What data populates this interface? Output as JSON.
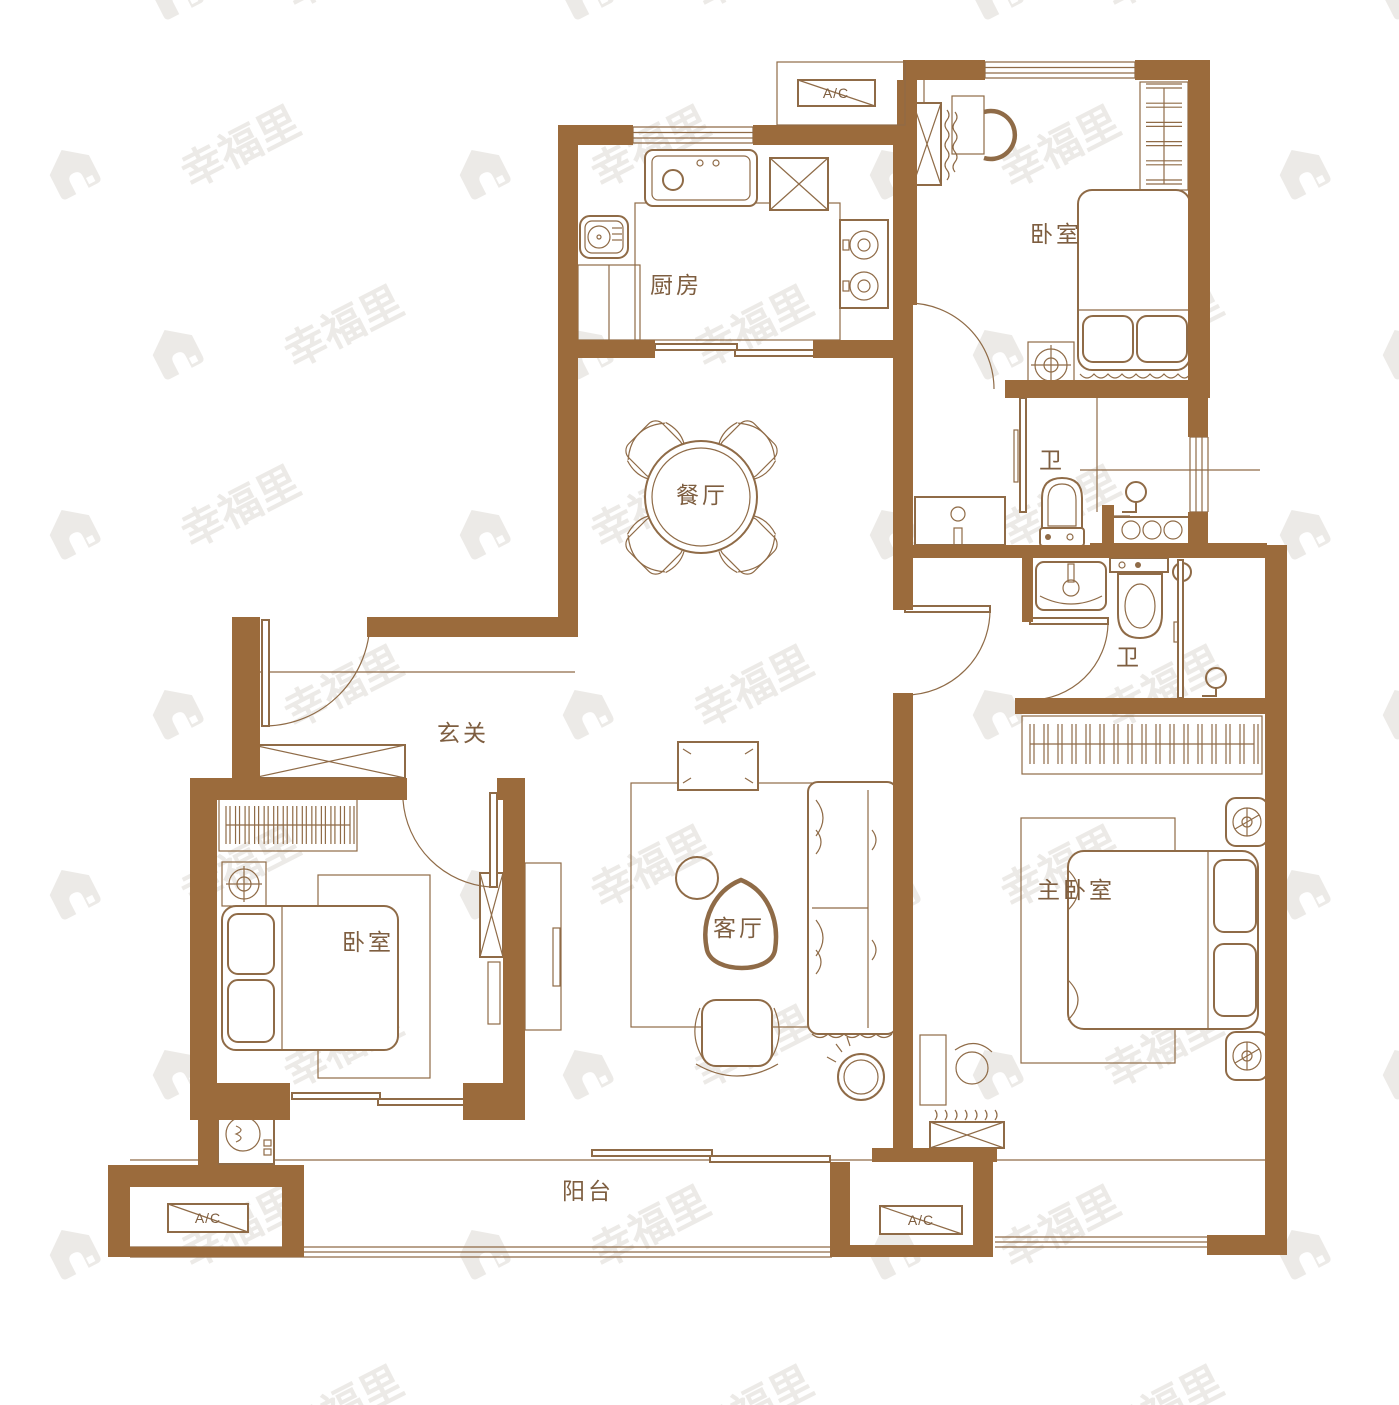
{
  "meta": {
    "title": "apartment-floor-plan",
    "width": 1399,
    "height": 1405
  },
  "palette": {
    "wall": "#9B6B3C",
    "line": "#8F6B47",
    "label": "#7E5E40",
    "watermark": "#ECEAE7",
    "background": "#FFFFFF"
  },
  "rooms": [
    {
      "id": "kitchen",
      "label": "厨房",
      "x": 676,
      "y": 293
    },
    {
      "id": "bedroom-top-right",
      "label": "卧室",
      "x": 1056,
      "y": 242
    },
    {
      "id": "dining-room",
      "label": "餐厅",
      "x": 702,
      "y": 503
    },
    {
      "id": "bathroom-1",
      "label": "卫",
      "x": 1052,
      "y": 468
    },
    {
      "id": "bathroom-2",
      "label": "卫",
      "x": 1129,
      "y": 665
    },
    {
      "id": "entry-hall",
      "label": "玄关",
      "x": 463,
      "y": 741
    },
    {
      "id": "bedroom-left",
      "label": "卧室",
      "x": 368,
      "y": 950
    },
    {
      "id": "living-room",
      "label": "客厅",
      "x": 739,
      "y": 936
    },
    {
      "id": "master-bedroom",
      "label": "主卧室",
      "x": 1076,
      "y": 898
    },
    {
      "id": "balcony",
      "label": "阳台",
      "x": 588,
      "y": 1199
    }
  ],
  "ac_units": [
    {
      "id": "ac-top",
      "label": "A/C",
      "x": 836,
      "y": 98
    },
    {
      "id": "ac-bottom-left",
      "label": "A/C",
      "x": 208,
      "y": 1223
    },
    {
      "id": "ac-bottom-middle",
      "label": "A/C",
      "x": 921,
      "y": 1225
    }
  ],
  "watermark": {
    "text": "幸福里",
    "icon": "house-icon"
  }
}
